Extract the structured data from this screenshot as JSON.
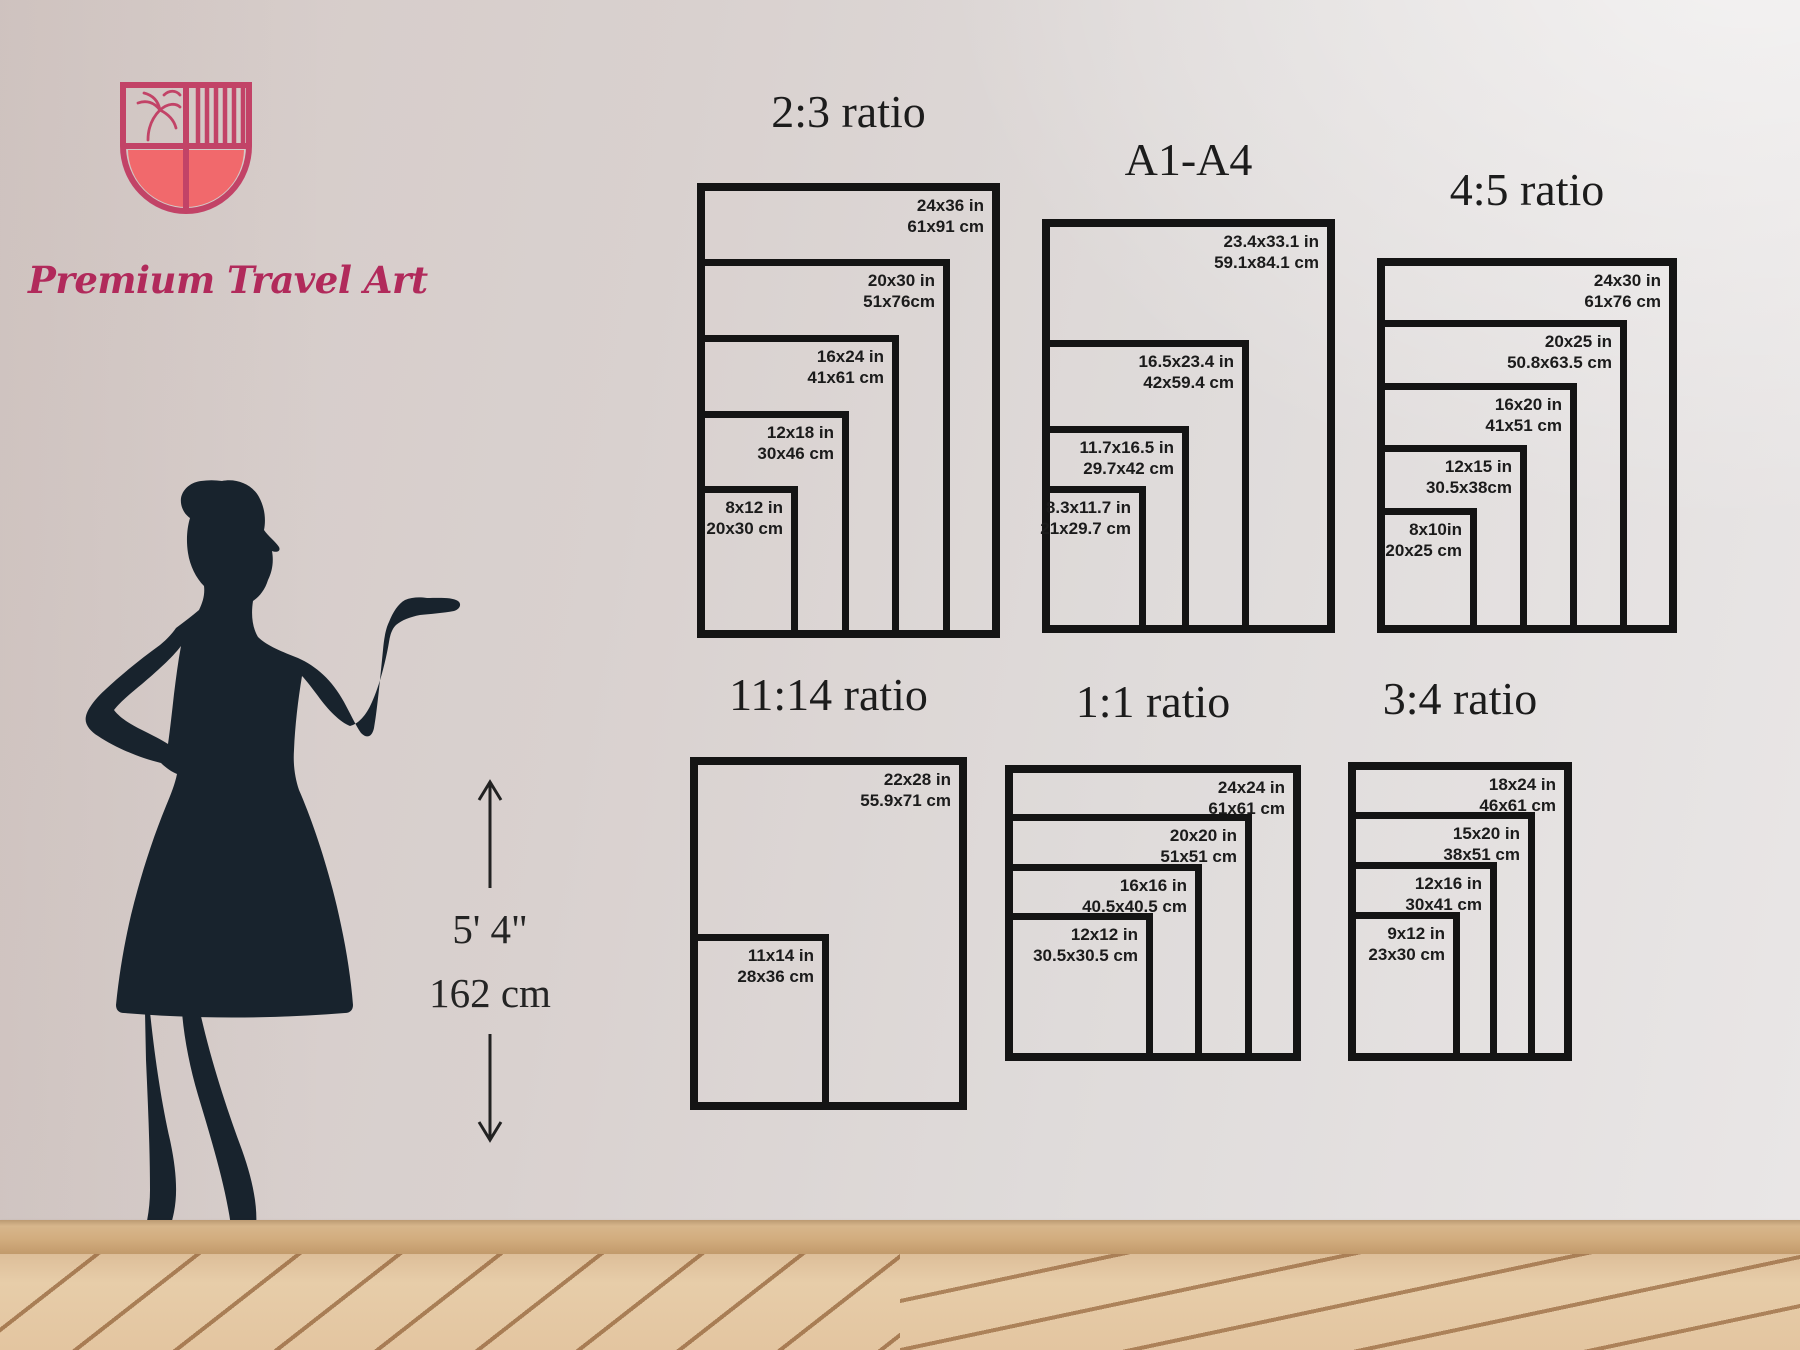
{
  "brand": {
    "name": "Premium Travel Art"
  },
  "height_marker": {
    "imperial": "5' 4\"",
    "metric": "162 cm"
  },
  "size_charts": [
    {
      "id": "2-3-ratio",
      "title": "2:3 ratio",
      "sizes": [
        {
          "inches": "24x36 in",
          "cm": "61x91 cm",
          "w": 24,
          "h": 36
        },
        {
          "inches": "20x30 in",
          "cm": "51x76cm",
          "w": 20,
          "h": 30
        },
        {
          "inches": "16x24 in",
          "cm": "41x61 cm",
          "w": 16,
          "h": 24
        },
        {
          "inches": "12x18 in",
          "cm": "30x46 cm",
          "w": 12,
          "h": 18
        },
        {
          "inches": "8x12 in",
          "cm": "20x30 cm",
          "w": 8,
          "h": 12
        }
      ]
    },
    {
      "id": "a1-a4",
      "title": "A1-A4",
      "sizes": [
        {
          "inches": "23.4x33.1 in",
          "cm": "59.1x84.1 cm",
          "w": 23.4,
          "h": 33.1
        },
        {
          "inches": "16.5x23.4 in",
          "cm": "42x59.4 cm",
          "w": 16.5,
          "h": 23.4
        },
        {
          "inches": "11.7x16.5 in",
          "cm": "29.7x42 cm",
          "w": 11.7,
          "h": 16.5
        },
        {
          "inches": "8.3x11.7 in",
          "cm": "21x29.7 cm",
          "w": 8.3,
          "h": 11.7
        }
      ]
    },
    {
      "id": "4-5-ratio",
      "title": "4:5 ratio",
      "sizes": [
        {
          "inches": "24x30 in",
          "cm": "61x76 cm",
          "w": 24,
          "h": 30
        },
        {
          "inches": "20x25 in",
          "cm": "50.8x63.5 cm",
          "w": 20,
          "h": 25
        },
        {
          "inches": "16x20 in",
          "cm": "41x51 cm",
          "w": 16,
          "h": 20
        },
        {
          "inches": "12x15 in",
          "cm": "30.5x38cm",
          "w": 12,
          "h": 15
        },
        {
          "inches": "8x10in",
          "cm": "20x25 cm",
          "w": 8,
          "h": 10
        }
      ]
    },
    {
      "id": "11-14-ratio",
      "title": "11:14 ratio",
      "sizes": [
        {
          "inches": "22x28 in",
          "cm": "55.9x71 cm",
          "w": 22,
          "h": 28
        },
        {
          "inches": "11x14 in",
          "cm": "28x36 cm",
          "w": 11,
          "h": 14
        }
      ]
    },
    {
      "id": "1-1-ratio",
      "title": "1:1 ratio",
      "sizes": [
        {
          "inches": "24x24 in",
          "cm": "61x61 cm",
          "w": 24,
          "h": 24
        },
        {
          "inches": "20x20 in",
          "cm": "51x51 cm",
          "w": 20,
          "h": 20
        },
        {
          "inches": "16x16 in",
          "cm": "40.5x40.5 cm",
          "w": 16,
          "h": 16
        },
        {
          "inches": "12x12 in",
          "cm": "30.5x30.5 cm",
          "w": 12,
          "h": 12
        }
      ]
    },
    {
      "id": "3-4-ratio",
      "title": "3:4 ratio",
      "sizes": [
        {
          "inches": "18x24 in",
          "cm": "46x61 cm",
          "w": 18,
          "h": 24
        },
        {
          "inches": "15x20 in",
          "cm": "38x51 cm",
          "w": 15,
          "h": 20
        },
        {
          "inches": "12x16 in",
          "cm": "30x41 cm",
          "w": 12,
          "h": 16
        },
        {
          "inches": "9x12 in",
          "cm": "23x30 cm",
          "w": 9,
          "h": 12
        }
      ]
    }
  ],
  "colors": {
    "frame": "#141414",
    "silhouette": "#18232d",
    "brand_pink": "#b12a5b",
    "logo_stroke": "#c24367",
    "logo_coral": "#f1696c",
    "wall": "#dcd5d2",
    "floor_wood": "#e3c5a0"
  }
}
